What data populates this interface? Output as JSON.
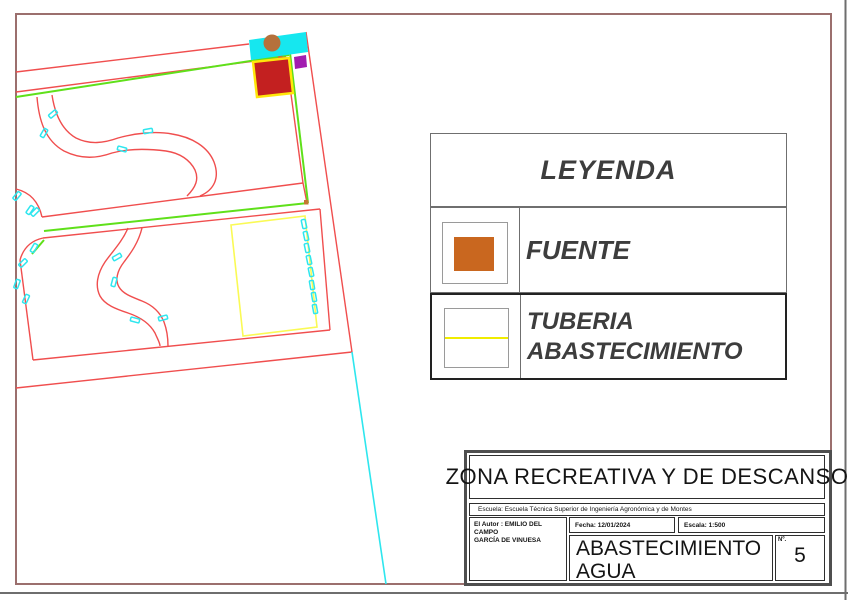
{
  "legend": {
    "title": "LEYENDA",
    "items": [
      {
        "label": "FUENTE",
        "symbol": "fuente-orange-square",
        "symbol_color": "#c9671f"
      },
      {
        "label_line1": "TUBERIA",
        "label_line2": "ABASTECIMIENTO",
        "symbol": "tuberia-yellow-line",
        "symbol_color": "#f0ec00"
      }
    ]
  },
  "title_block": {
    "project_title": "ZONA RECREATIVA Y DE DESCANSO",
    "school": "Escuela: Escuela Técnica Superior de Ingeniería Agronómica y de Montes",
    "author_line1": "El Autor : EMILIO DEL CAMPO",
    "author_line2": "GARCÍA DE VINUESA",
    "date": "Fecha: 12/01/2024",
    "scale": "Escala: 1:500",
    "sheet_line1": "ABASTECIMIENTO",
    "sheet_line2": "AGUA",
    "number_label": "Nº.",
    "sheet_number": "5"
  },
  "drawing": {
    "colors": {
      "parcel_outline_red": "#f04e4e",
      "pipe_green": "#5fe01a",
      "water_cyan": "#2ee6ee",
      "pipe_yellow": "#f5f151",
      "fountain_orange": "#b5713c",
      "building_red": "#c32020",
      "building_border_yellow": "#ffe70a",
      "accessory_purple": "#a21cb0",
      "page_border_maroon": "#9b6f6d"
    }
  }
}
